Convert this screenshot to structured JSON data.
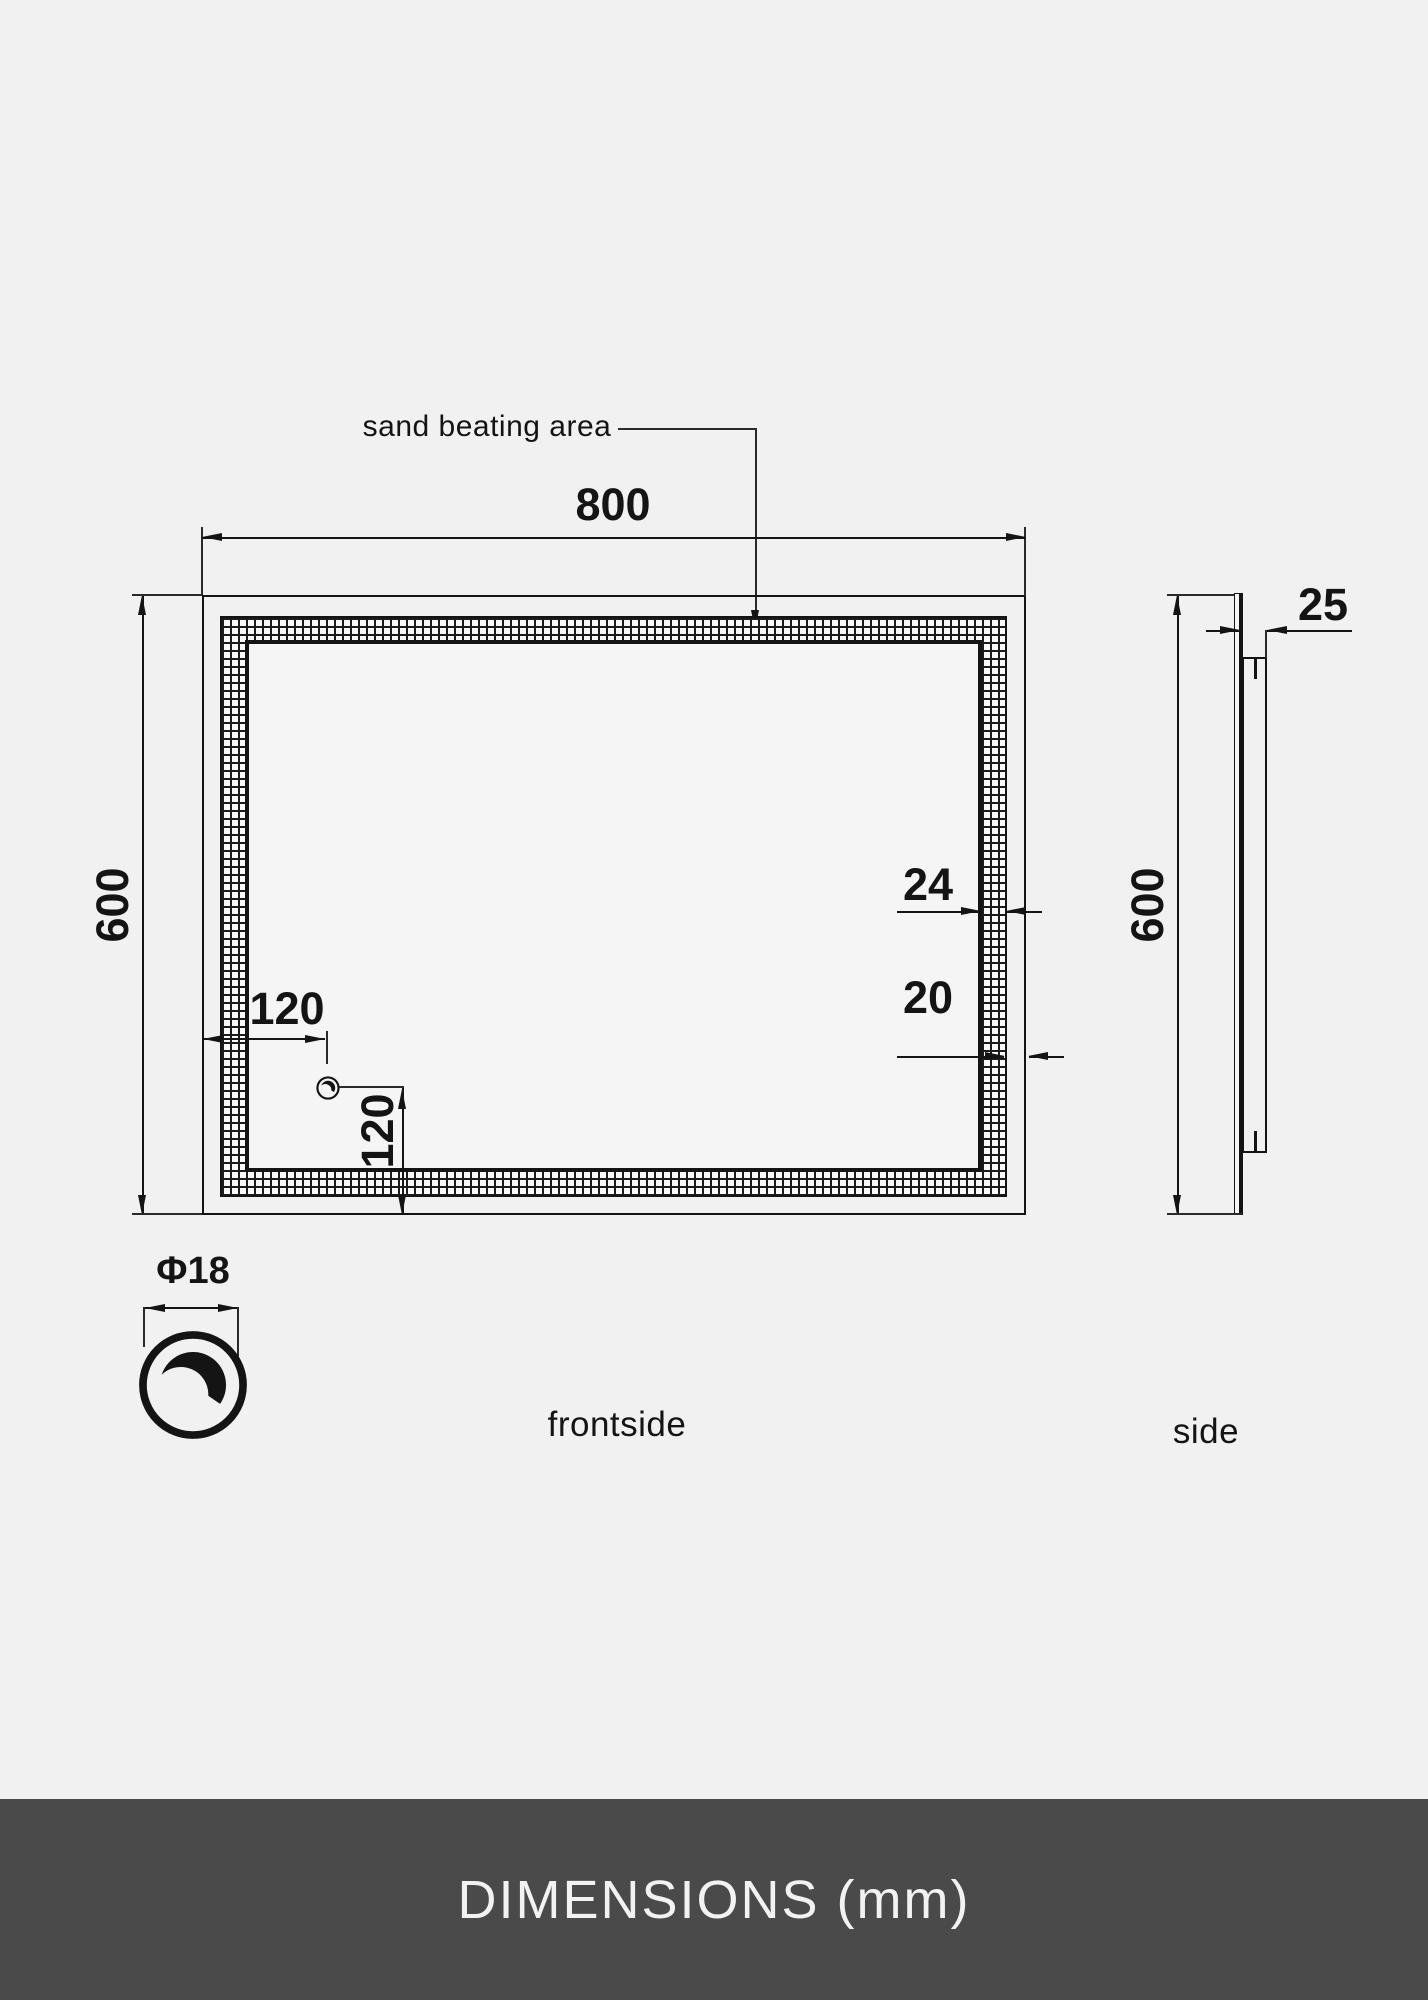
{
  "annotation": {
    "sand_beating_area": "sand beating area"
  },
  "front": {
    "label": "frontside",
    "width": "800",
    "height": "600",
    "band_width": "24",
    "band_inset": "20",
    "knob_offset_x": "120",
    "knob_offset_y": "120"
  },
  "knob": {
    "diameter": "Φ18"
  },
  "side": {
    "label": "side",
    "depth": "25",
    "height": "600"
  },
  "footer": {
    "title": "DIMENSIONS (mm)"
  },
  "colors": {
    "background": "#f1f1f1",
    "ink": "#141414",
    "footer_bg": "#4a4a4a",
    "footer_text": "#f2f2f2"
  }
}
